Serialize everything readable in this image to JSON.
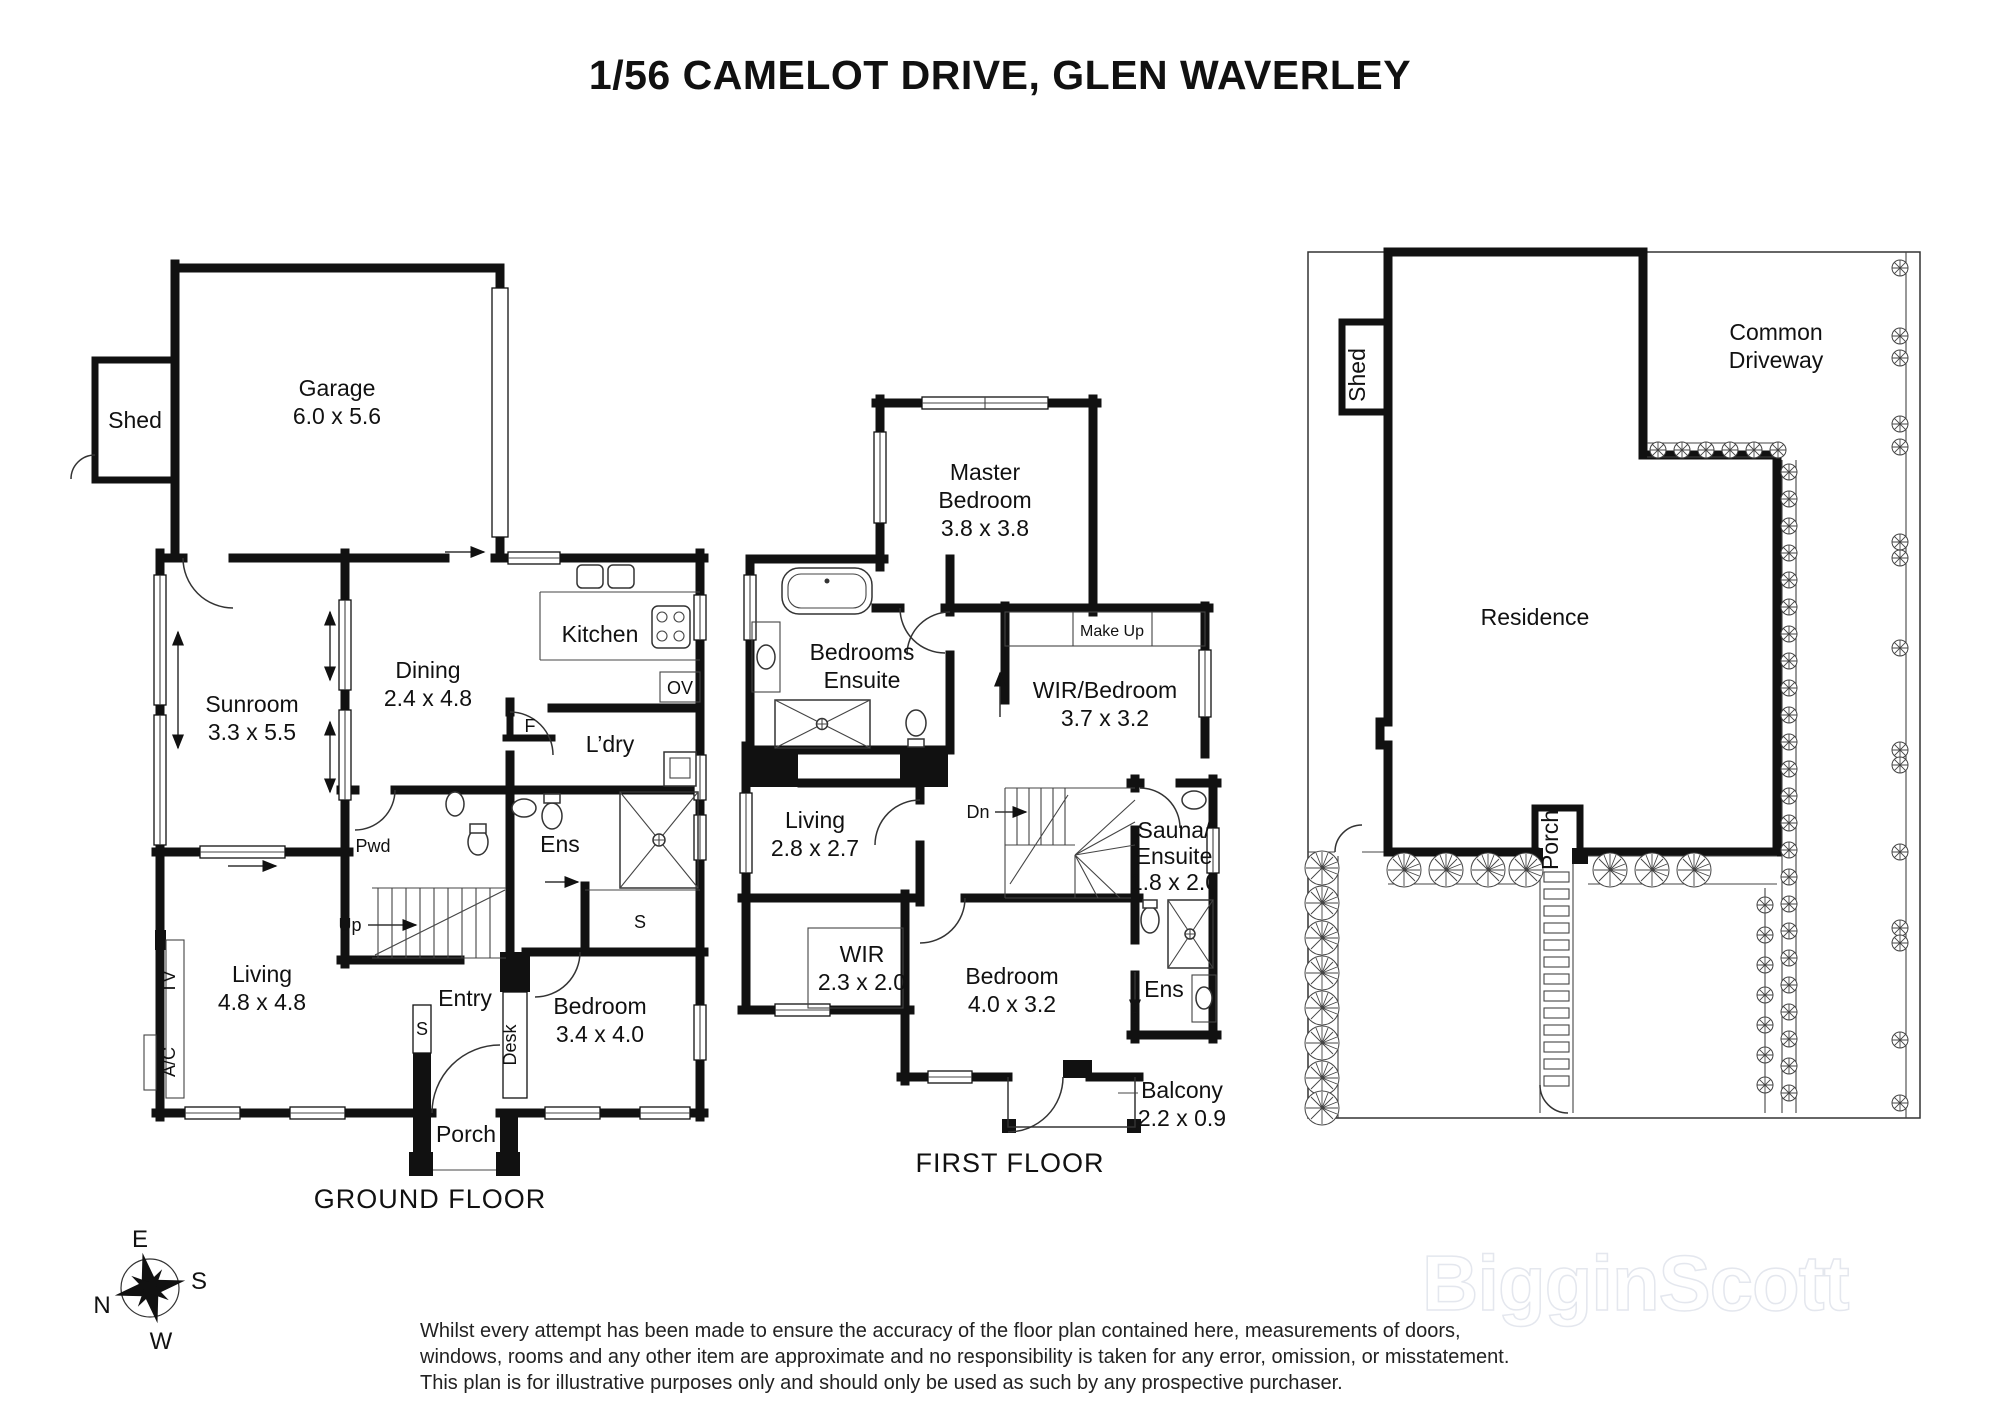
{
  "title": "1/56 CAMELOT DRIVE, GLEN WAVERLEY",
  "plans": {
    "ground_floor": {
      "name": "GROUND FLOOR",
      "rooms": {
        "shed": {
          "label": "Shed"
        },
        "garage": {
          "label": "Garage",
          "dims": "6.0 x 5.6"
        },
        "sunroom": {
          "label": "Sunroom",
          "dims": "3.3 x 5.5"
        },
        "dining": {
          "label": "Dining",
          "dims": "2.4 x 4.8"
        },
        "kitchen": {
          "label": "Kitchen"
        },
        "laundry": {
          "label": "L’dry"
        },
        "powder": {
          "label": "Pwd"
        },
        "ensuite": {
          "label": "Ens"
        },
        "living": {
          "label": "Living",
          "dims": "4.8 x 4.8"
        },
        "entry": {
          "label": "Entry"
        },
        "bedroom": {
          "label": "Bedroom",
          "dims": "3.4 x 4.0"
        },
        "porch": {
          "label": "Porch"
        }
      },
      "annotations": {
        "up": "Up",
        "oven": "OV",
        "fridge": "F",
        "store_hall": "S",
        "store_ens": "S",
        "tv": "TV",
        "ac": "A/C",
        "desk": "Desk"
      }
    },
    "first_floor": {
      "name": "FIRST FLOOR",
      "rooms": {
        "master": {
          "label1": "Master",
          "label2": "Bedroom",
          "dims": "3.8 x 3.8"
        },
        "bedrooms_ensuite": {
          "label1": "Bedrooms",
          "label2": "Ensuite"
        },
        "makeup": {
          "label": "Make Up"
        },
        "wir_bedroom": {
          "label": "WIR/Bedroom",
          "dims": "3.7 x 3.2"
        },
        "living": {
          "label": "Living",
          "dims": "2.8 x 2.7"
        },
        "sauna": {
          "label1": "Sauna/",
          "label2": "Ensuite",
          "dims": "1.8 x 2.0"
        },
        "wir": {
          "label": "WIR",
          "dims": "2.3 x 2.0"
        },
        "bedroom": {
          "label": "Bedroom",
          "dims": "4.0 x 3.2"
        },
        "ensuite": {
          "label": "Ens"
        },
        "balcony": {
          "label": "Balcony",
          "dims": "2.2 x 0.9"
        }
      },
      "annotations": {
        "down": "Dn"
      }
    },
    "site": {
      "labels": {
        "shed": "Shed",
        "common1": "Common",
        "common2": "Driveway",
        "residence": "Residence",
        "porch": "Porch"
      }
    }
  },
  "compass": {
    "n": "N",
    "e": "E",
    "s": "S",
    "w": "W"
  },
  "disclaimer": {
    "line1": "Whilst every attempt has been made to ensure the accuracy of the floor plan contained here, measurements of doors,",
    "line2": "windows, rooms and any other item are approximate and no responsibility is taken for any error, omission, or misstatement.",
    "line3": "This plan is for illustrative purposes only and should only be used as such by any prospective purchaser."
  },
  "watermark": "BigginScott",
  "colors": {
    "wall": "#111111",
    "background": "#ffffff",
    "watermark_outline": "#e4e7ee"
  }
}
